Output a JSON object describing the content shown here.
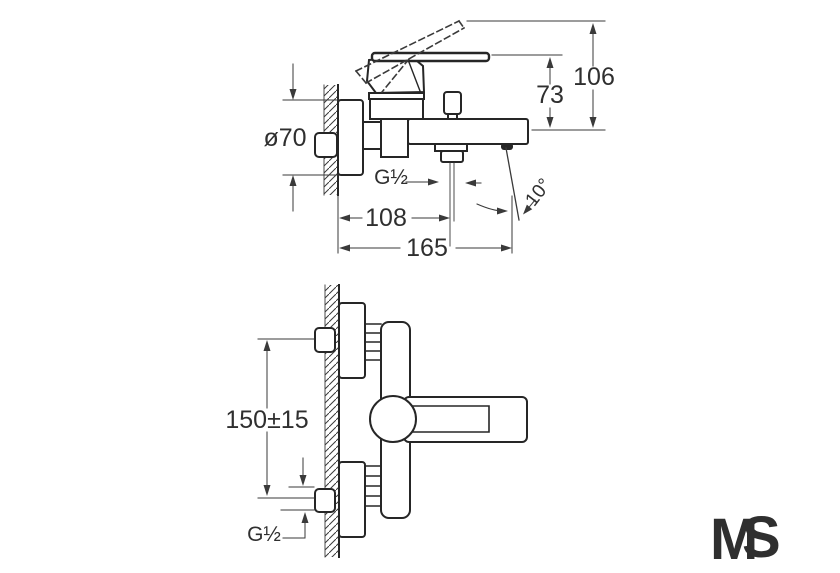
{
  "side_view": {
    "dims": {
      "overall_height": "106",
      "handle_height": "73",
      "escutcheon_diameter": "ø70",
      "shower_outlet_thread": "G½",
      "outlet_offset": "108",
      "spout_reach": "165",
      "spout_angle": "10°"
    }
  },
  "front_view": {
    "dims": {
      "connection_spacing": "150±15",
      "connection_thread": "G½"
    }
  },
  "logo": {
    "letter_m": "M",
    "letter_s": "S",
    "m_color": "#4ccc32",
    "s_color": "#2d3c54"
  },
  "colors": {
    "background": "#ffffff",
    "outline": "#262626",
    "dimension_line": "#3a3a3a"
  }
}
